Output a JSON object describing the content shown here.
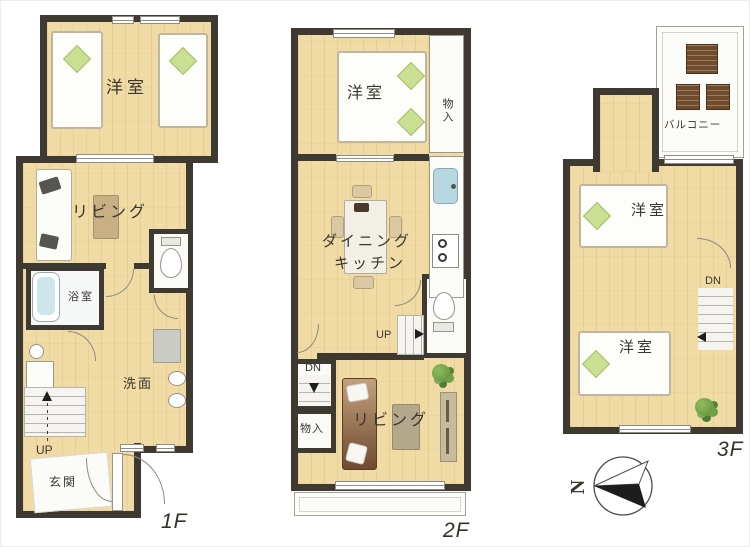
{
  "floors": {
    "f1": {
      "floor_label": "1F",
      "bedroom": "洋室",
      "living": "リビング",
      "bath": "浴室",
      "washroom": "洗面",
      "entrance": "玄関",
      "stairs_up": "UP"
    },
    "f2": {
      "floor_label": "2F",
      "bedroom": "洋室",
      "closet_top": "物入",
      "dining_line1": "ダイニング",
      "dining_line2": "キッチン",
      "stairs_up": "UP",
      "stairs_down": "DN",
      "closet_bottom": "物入",
      "living": "リビング"
    },
    "f3": {
      "floor_label": "3F",
      "balcony": "バルコニー",
      "bedroom_top": "洋室",
      "bedroom_bottom": "洋室",
      "stairs_down": "DN"
    }
  },
  "compass": {
    "north_label": "N"
  },
  "colors": {
    "wall": "#3e3a32",
    "floor": "#f0dba5",
    "pillow_green": "#cadf92",
    "water_blue": "#b7d7e1",
    "plant_green": "#6f9e4a",
    "sofa_brown": "#8a5f3f",
    "wood_dark": "#6f4a2b"
  }
}
